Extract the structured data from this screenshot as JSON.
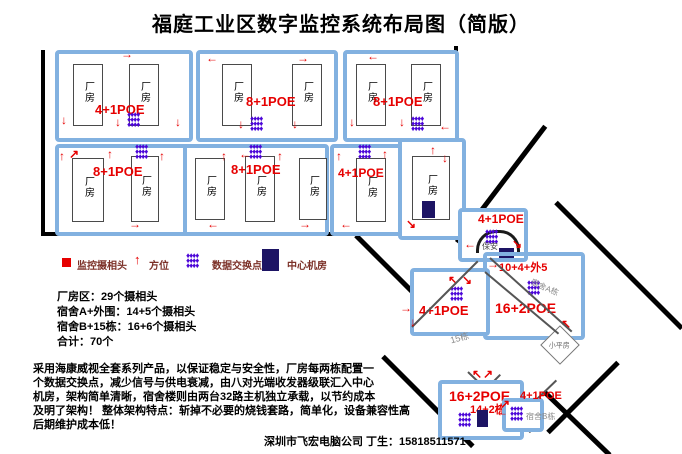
{
  "title": "福庭工业区数字监控系统布局图（简版）",
  "building_label": "厂房",
  "factory_blocks": [
    {
      "poe": "4+1POE"
    },
    {
      "poe": "8+1POE"
    },
    {
      "poe": "8+1POE"
    },
    {
      "poe": "8+1POE"
    },
    {
      "poe": "8+1POE"
    },
    {
      "poe": "4+1POE"
    }
  ],
  "legend": {
    "camera": "监控摄相头",
    "direction": "方位",
    "switch_point": "数据交换点",
    "center_room": "中心机房"
  },
  "stats": {
    "factory": "厂房区：29个摄相头",
    "dorm_a": "宿舍A+外围：14+5个摄相头",
    "dorm_b": "宿舍B+15栋：16+6个摄相头",
    "total": "合计：70个"
  },
  "description": {
    "line1": "采用海康威视全套系列产品，以保证稳定与安全性，厂房每两栋配置一",
    "line2": "个数据交换点，减少信号与供电衰减，由八对光端收发器级联汇入中心",
    "line3": "机房，架构简单清晰，宿舍楼则由两台32路主机独立承载，以节约成本",
    "line4": "及明了架构！ 整体架构特点：斩掉不必要的烧钱套路，简单化，设备兼容性高",
    "line5": "后期维护成本低！"
  },
  "footer": "深圳市飞宏电脑公司 丁生：15818511571",
  "site": {
    "guard": {
      "poe": "4+1POE",
      "label": "保安"
    },
    "dorm_a": {
      "count": "10+4+外5",
      "poe": "16+2POE",
      "label": "宿舍A栋"
    },
    "b15": {
      "poe": "4+1POE",
      "label": "15栋"
    },
    "dorm_b": {
      "poe": "16+2POE",
      "sub": "14+2栋",
      "poe2": "4+1POE",
      "label": "宿舍B栋"
    },
    "hut": "小平房"
  },
  "icons": {
    "cluster": "♦♦♦♦\n♦♦♦♦\n♦♦♦♦",
    "arrow_up": "↑",
    "arrow_down": "↓",
    "arrow_left": "←",
    "arrow_right": "→",
    "arrow_up_left": "↖",
    "arrow_up_right": "↗",
    "arrow_down_right": "↘",
    "arrow_down_left": "↙"
  },
  "colors": {
    "accent_red": "#e60000",
    "switch_purple": "#4c06d8",
    "center_navy": "#1d1464",
    "box_blue": "#82b1e0"
  }
}
